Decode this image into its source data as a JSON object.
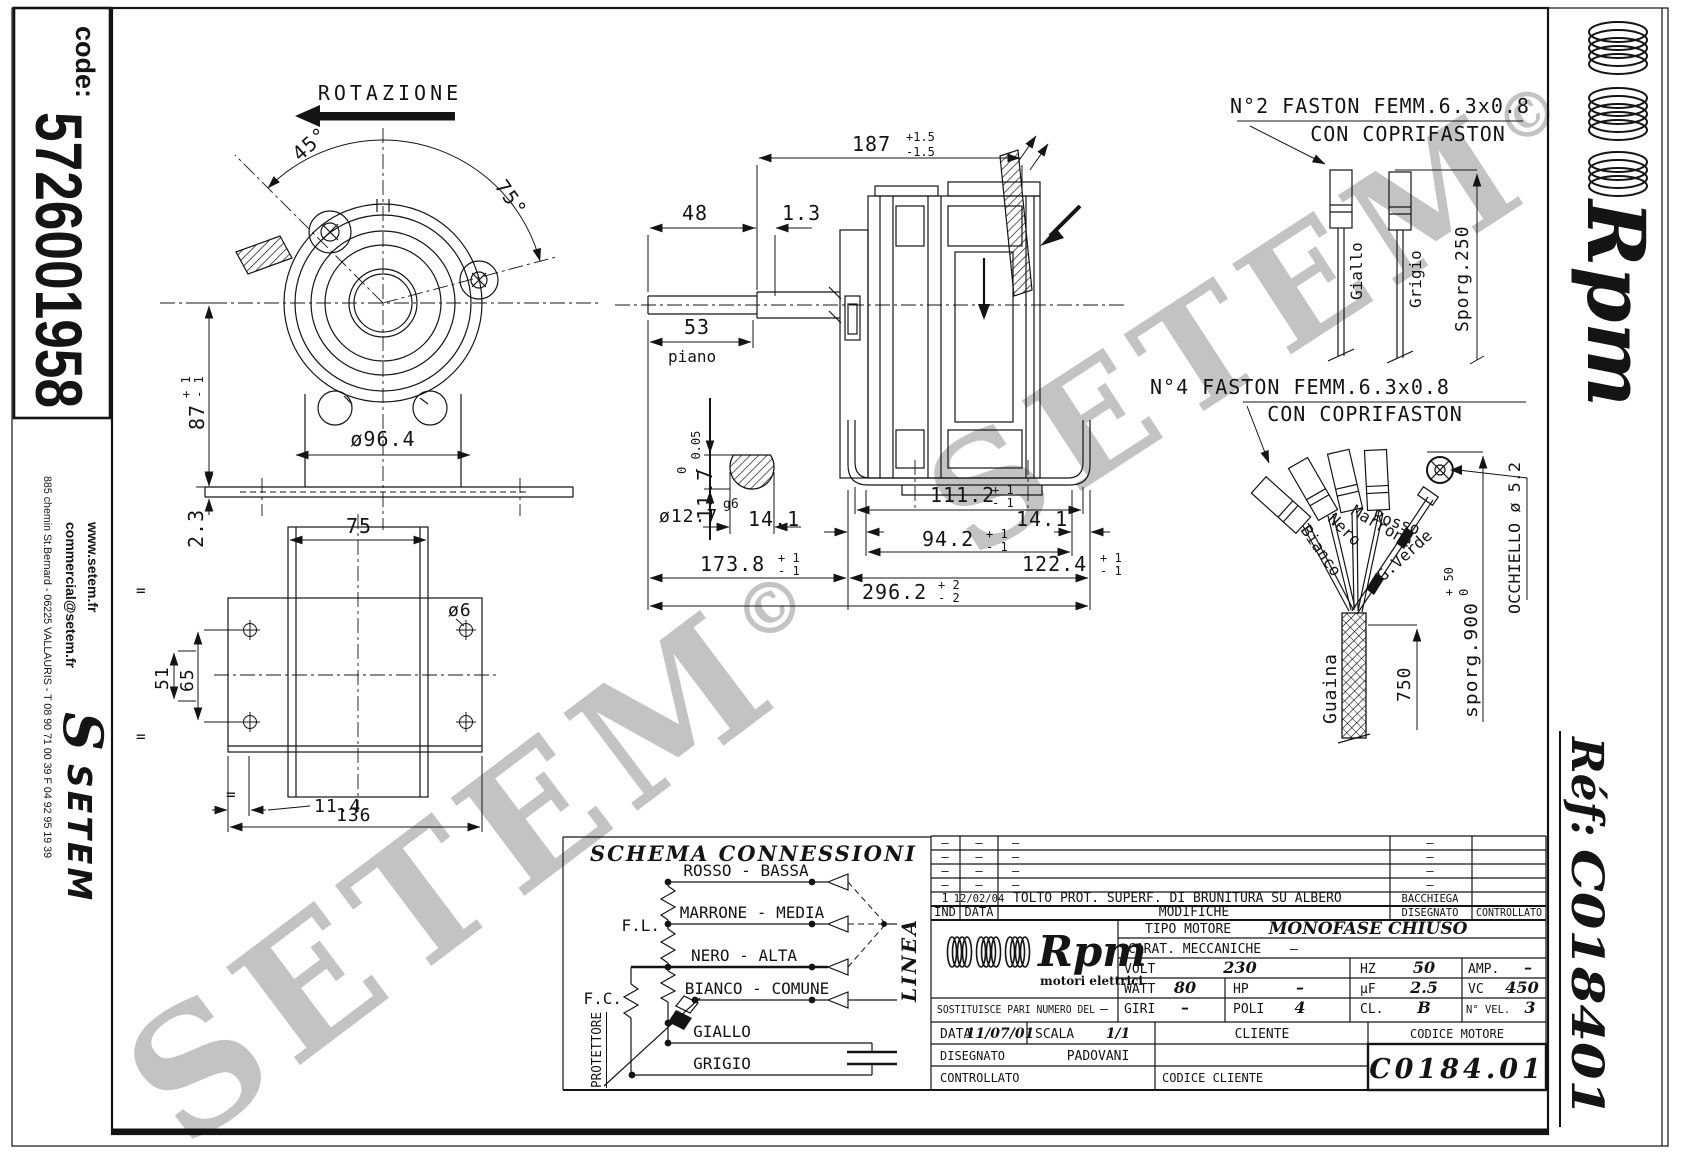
{
  "sidebar": {
    "code_label": "code:",
    "code_value": "5726001958",
    "address": "885 chemin St.Bernard  -  06225 VALLAURIS  -  T 08 90 71 00 39   F 04 92 95 19 39",
    "web": "www.setem.fr",
    "email": "commercial@setem.fr",
    "logo_s": "S",
    "brand": "SETEM"
  },
  "rightbar": {
    "brand": "Rpm",
    "ref_label": "Réf:",
    "ref_value": "C018401"
  },
  "watermark": {
    "text": "SETEM",
    "c": "©"
  },
  "front": {
    "rotazione": "ROTAZIONE",
    "a45": "45°",
    "a75": "75°",
    "d87": "87",
    "d87p": "+ 1",
    "d87m": "- 1",
    "d964": "ø96.4",
    "d23": "2.3"
  },
  "side": {
    "d187": "187",
    "d187p": "+1.5",
    "d187m": "-1.5",
    "d48": "48",
    "d13": "1.3",
    "d53": "53",
    "piano": "piano",
    "d117": "11.7",
    "d117p": "0",
    "d117m": "- 0.05",
    "d127": "ø12.7",
    "fit": "g6",
    "d141l": "14.1",
    "d141r": "14.1",
    "d1112": "111.2",
    "d1112p": "+ 1",
    "d1112m": "- 1",
    "d942": "94.2",
    "d942p": "+ 1",
    "d942m": "- 1",
    "d1738": "173.8",
    "d1738p": "+ 1",
    "d1738m": "- 1",
    "d1224": "122.4",
    "d1224p": "+ 1",
    "d1224m": "- 1",
    "d2962": "296.2",
    "d2962p": "+ 2",
    "d2962m": "- 2"
  },
  "bottomview": {
    "d75": "75",
    "d51": "51",
    "d65": "65",
    "d6": "ø6",
    "d114": "11.4",
    "d136": "136",
    "eq": "="
  },
  "faston2": {
    "l1": "N°2 FASTON FEMM.6.3x0.8",
    "l2": "CON COPRIFASTON",
    "w1": "Giallo",
    "w2": "Grigio",
    "sporg": "Sporg.250"
  },
  "faston4": {
    "l1": "N°4 FASTON FEMM.6.3x0.8",
    "l2": "CON COPRIFASTON",
    "w1": "Bianco",
    "w2": "Nero",
    "w3": "Marrone",
    "w4": "Rosso",
    "w5": "G.Verde",
    "guaina": "Guaina",
    "d750": "750",
    "sporg": "sporg.900",
    "sporgp": "+ 50",
    "sporgm": "0",
    "occhiello": "OCCHIELLO ø 5.2"
  },
  "schema": {
    "title": "SCHEMA CONNESSIONI",
    "r1": "ROSSO - BASSA",
    "r2": "MARRONE - MEDIA",
    "r3": "NERO - ALTA",
    "r4": "BIANCO - COMUNE",
    "r5": "GIALLO",
    "r6": "GRIGIO",
    "fl": "F.L.",
    "fc": "F.C.",
    "protettore": "PROTETTORE",
    "linea": "LINEA"
  },
  "tb": {
    "dash": "–",
    "rev1_ind": "1",
    "rev1_data": "12/02/04",
    "rev1_mod": "TOLTO PROT. SUPERF. DI BRUNITURA  SU  ALBERO",
    "rev1_dis": "BACCHIEGA",
    "h_ind": "IND",
    "h_data": "DATA",
    "h_mod": "MODIFICHE",
    "h_dis": "DISEGNATO",
    "h_con": "CONTROLLATO",
    "brand": "Rpm",
    "brand_sub": "motori elettrici",
    "tipo_l": "TIPO MOTORE",
    "tipo_v": "MONOFASE CHIUSO",
    "carat_l": "CARAT. MECCANICHE",
    "carat_v": "–",
    "volt_l": "VOLT",
    "volt_v": "230",
    "hz_l": "HZ",
    "hz_v": "50",
    "amp_l": "AMP.",
    "amp_v": "–",
    "watt_l": "WATT",
    "watt_v": "80",
    "hp_l": "HP",
    "hp_v": "–",
    "uf_l": "µF",
    "uf_v": "2.5",
    "vc_l": "VC",
    "vc_v": "450",
    "giri_l": "GIRI",
    "giri_v": "–",
    "poli_l": "POLI",
    "poli_v": "4",
    "cl_l": "CL.",
    "cl_v": "B",
    "nvel_l": "N° VEL.",
    "nvel_v": "3",
    "sost_l": "SOSTITUISCE PARI NUMERO DEL",
    "sost_v": "–",
    "data_l": "DATA",
    "data_v": "11/07/01",
    "scala_l": "SCALA",
    "scala_v": "1/1",
    "cliente_l": "CLIENTE",
    "codmot_l": "CODICE MOTORE",
    "codmot_v": "C0184.01",
    "dis_l": "DISEGNATO",
    "dis_v": "PADOVANI",
    "con_l": "CONTROLLATO",
    "codcli_l": "CODICE CLIENTE"
  }
}
